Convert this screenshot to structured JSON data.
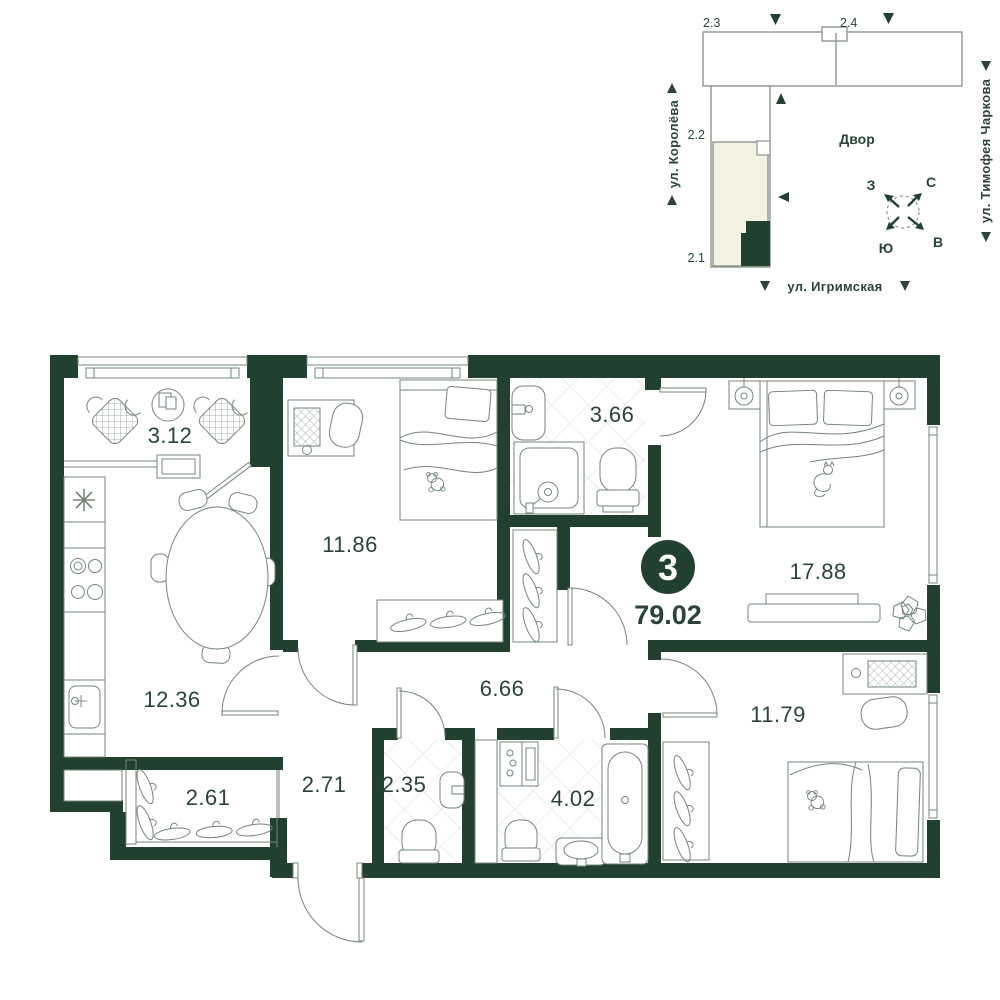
{
  "colors": {
    "wall": "#22402f",
    "furniture_line": "#75857a",
    "text": "#2b4437",
    "tile_line": "#d8ded8",
    "highlight_cream": "#f4f3e2",
    "map_outline": "#8b968c"
  },
  "plan": {
    "badge": {
      "rooms_count": "3",
      "area": "79.02"
    },
    "rooms": [
      {
        "id": "loggia",
        "label": "3.12"
      },
      {
        "id": "bedroom-1",
        "label": "11.86"
      },
      {
        "id": "bathroom-1",
        "label": "3.66"
      },
      {
        "id": "master-bedroom",
        "label": "17.88"
      },
      {
        "id": "kitchen",
        "label": "12.36"
      },
      {
        "id": "hallway",
        "label": "6.66"
      },
      {
        "id": "corridor",
        "label": "2.71"
      },
      {
        "id": "wardrobe",
        "label": "2.61"
      },
      {
        "id": "wc",
        "label": "2.35"
      },
      {
        "id": "bathroom-2",
        "label": "4.02"
      },
      {
        "id": "bedroom-2",
        "label": "11.79"
      }
    ]
  },
  "site": {
    "sections": [
      {
        "label": "2.3"
      },
      {
        "label": "2.4"
      },
      {
        "label": "2.2"
      },
      {
        "label": "2.1"
      }
    ],
    "courtyard": "Двор",
    "streets": {
      "left": "ул. Королёва",
      "right": "ул. Тимофея Чаркова",
      "bottom": "ул. Игримская"
    },
    "compass": {
      "north": "С",
      "south": "Ю",
      "west": "З",
      "east": "В"
    }
  }
}
